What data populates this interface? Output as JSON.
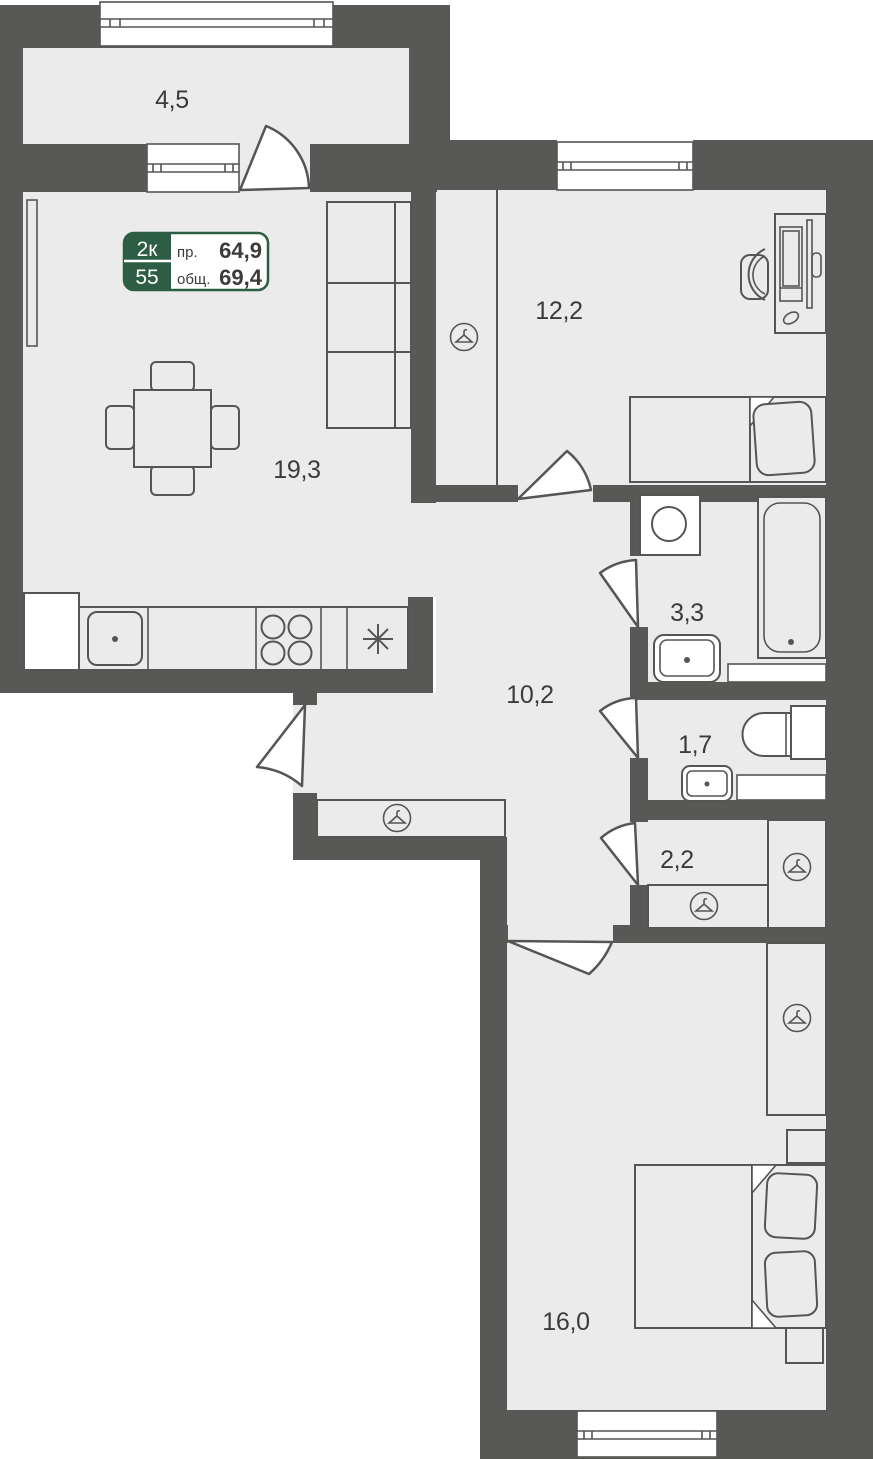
{
  "plan": {
    "type": "apartment-floor-plan",
    "unit_badge": {
      "rooms_count": "2к",
      "unit_number": "55",
      "living_area_label": "пр.",
      "living_area_value": "64,9",
      "total_area_label": "общ.",
      "total_area_value": "69,4"
    },
    "rooms": [
      {
        "name": "balcony",
        "area": "4,5"
      },
      {
        "name": "living-kitchen",
        "area": "19,3"
      },
      {
        "name": "bedroom-top",
        "area": "12,2"
      },
      {
        "name": "hallway",
        "area": "10,2"
      },
      {
        "name": "bathroom",
        "area": "3,3"
      },
      {
        "name": "wc",
        "area": "1,7"
      },
      {
        "name": "closet",
        "area": "2,2"
      },
      {
        "name": "bedroom-bottom",
        "area": "16,0"
      }
    ],
    "icons": [
      "hanger-icon",
      "sink-icon",
      "stove-icon",
      "asterisk-icon",
      "window-symbol",
      "door-swing"
    ],
    "colors": {
      "wall": "#585856",
      "floor": "#ebebeb",
      "outline": "#555553",
      "badge_green": "#2d5e44",
      "text": "#3b3b39",
      "paper": "#ffffff"
    }
  }
}
